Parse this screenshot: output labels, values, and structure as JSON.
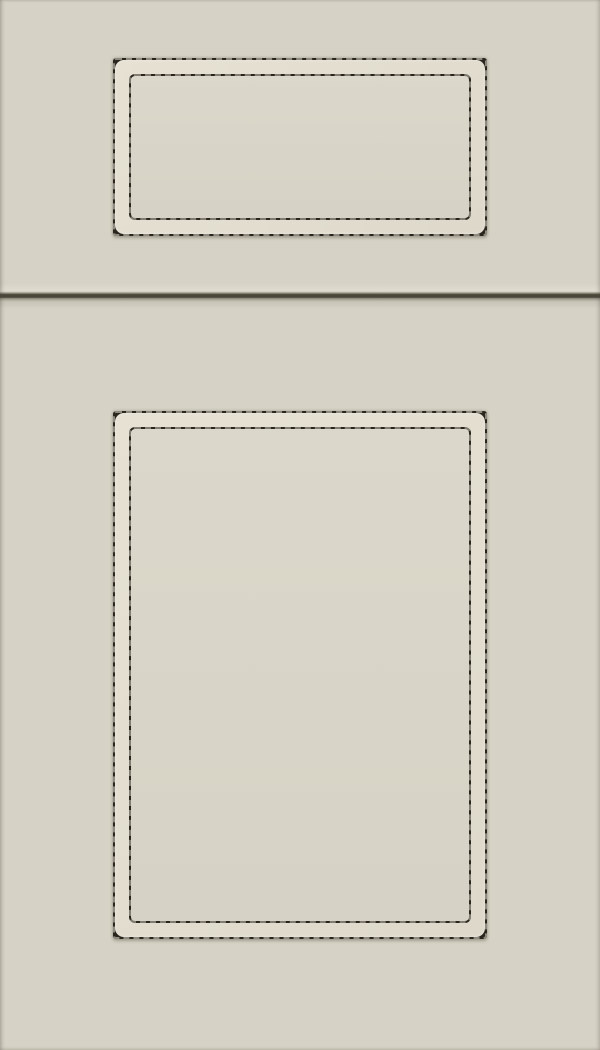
{
  "scene": {
    "description": "Product photo of a painted shaker-style cabinet sample: a rectangular drawer front above a tall cabinet door, both with a recessed center panel outlined by a dark hand-glazed distressed line, finished in a light greige paint."
  },
  "colors": {
    "base_paint": "#d6d2c5",
    "frame_band": "#e2ddcf",
    "panel_fill": "#d8d4c7",
    "glaze_line": "#2a261e",
    "divider_line": "#4b473a",
    "divider_highlight": "#e0dccf",
    "divider_shadow": "#c7c3b6"
  },
  "parts": {
    "drawer_front": "drawer-front",
    "door_front": "door-front",
    "rail_divider": "rail-joint-line",
    "glaze_outline": "distressed-glaze-outline",
    "center_panel": "recessed-center-panel"
  }
}
